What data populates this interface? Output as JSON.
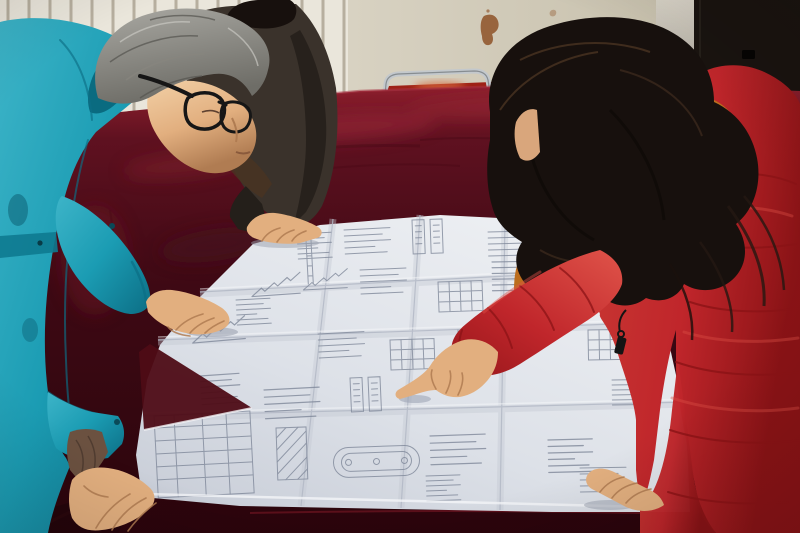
{
  "scene": {
    "type": "photograph",
    "description": "Two workers lean over a large folded engineering blueprint spread on a dark red velvet covered table; a gray-haired man in a teal work jacket and glasses studies the sheet while a woman in a red fur-trimmed winter parka points at a detail with her index finger; a third person in a dark jacket rests a hand on the top edge of the drawing.",
    "setting": "room interior with a white fin radiator, a stained cream wall, a dark door panel and a metal framed chair with a red seat",
    "objects": {
      "radiator": "white wall radiator with vertical fins",
      "wall": "cream wall with rust stain",
      "dark_wall": "dark door panel on the right",
      "chair": "metal framed chair with red seat behind the table",
      "table": "table covered with dark red velvet cloth",
      "blueprint": "large folded engineering blueprint sheet with structural detail drawings, schedule tables and a stadium shaped section detail",
      "man_left": "man in teal work jacket with gray hair and black glasses leaning on the table",
      "person_back": "second person in a dark jacket resting a hand on the blueprint",
      "woman_right": "woman in red hooded parka with orange fur trim and long dark hair pointing at the blueprint",
      "pointing_hand": "woman's right hand with extended index finger",
      "woman_left_hand": "woman's left hand resting on the blueprint",
      "man_right_hand": "man's right hand resting on the blueprint",
      "man_left_hand": "man's left hand resting on the table corner"
    }
  },
  "palette": {
    "radiator": "#eae6db",
    "radiator_slat": "#a69d8b",
    "wall": "#d8d2c2",
    "wall_shade": "#c7c0ac",
    "door_strip_top": "#d8d3c7",
    "door_strip_bottom": "#564f48",
    "dark_wall": "#1a1410",
    "rust": "#8a4a1e",
    "chair_frame": "#c3c8cc",
    "chair_seat": "#9e2217",
    "velvet_top": "#8f1f2d",
    "velvet_mid": "#5f1120",
    "velvet_dark": "#3e0914",
    "velvet_deep": "#2b050c",
    "velvet_sheen": "#a63040",
    "paper_light": "#eff1f4",
    "paper_shade": "#c9ced8",
    "crease": "#b3b9c6",
    "ink": "#7d8698",
    "teal": "#1b9cb3",
    "teal_light": "#3db4c8",
    "teal_dark": "#0c6e85",
    "lining": "#6b5140",
    "jacket_dark": "#3a322b",
    "jacket_dark2": "#241f1a",
    "hair_black": "#17100d",
    "hair_gray_light": "#a9a8a2",
    "hair_gray_dark": "#6e6d67",
    "hair_brown": "#4a3322",
    "skin": "#e2af7f",
    "skin_light": "#f2d0a6",
    "skin_shadow": "#b07c52",
    "coat_red": "#c0262b",
    "coat_red_dark": "#8c1316",
    "coat_red_light": "#dd5047",
    "fur": "#bc6d1d",
    "fur_light": "#e59c3f",
    "fur_dark": "#4a2c0e",
    "zipper": "#141414"
  }
}
